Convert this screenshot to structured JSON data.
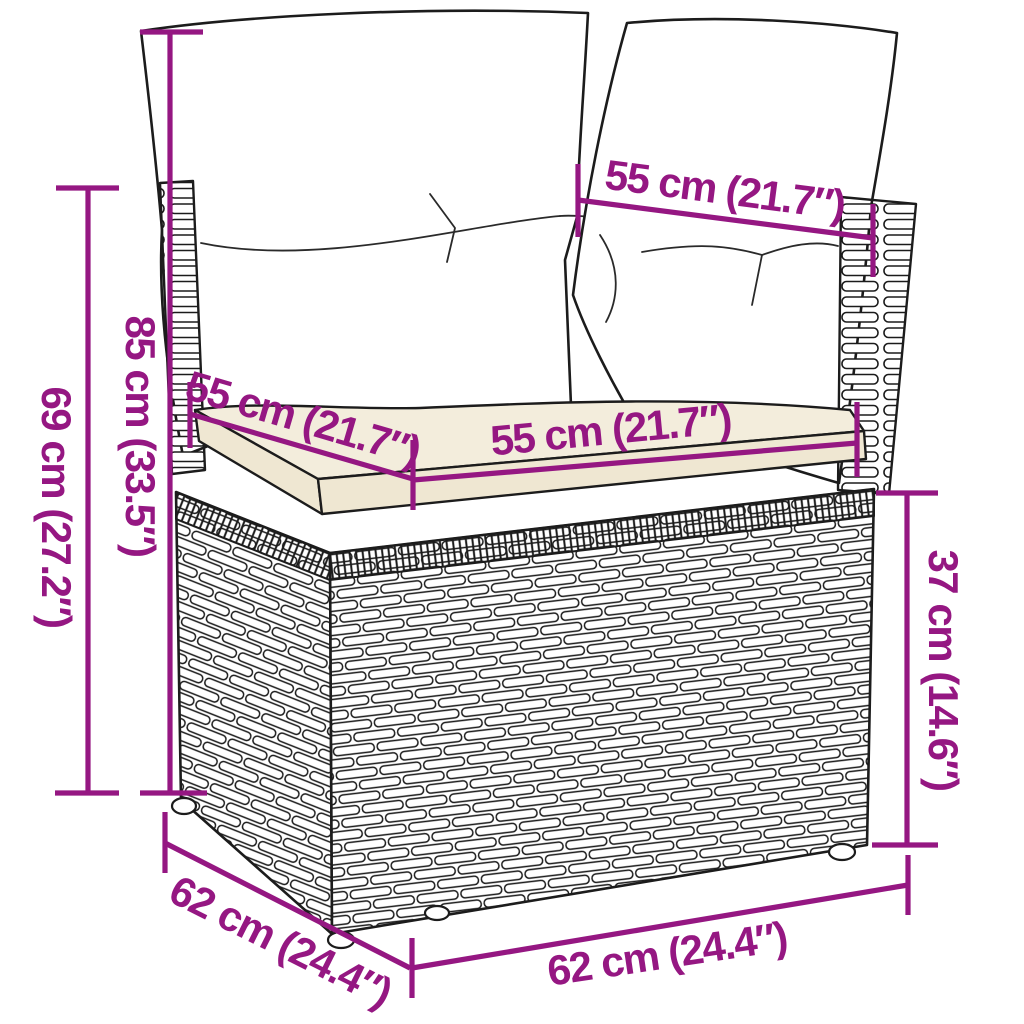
{
  "figure": {
    "description": "line drawing of a poly rattan corner sofa module with back cushions and seat cushion, annotated with measurements",
    "accent_color": "#951782",
    "outline_color": "#1c1c1c",
    "cushion_fill": "#ffffff",
    "seat_cushion_fill": "#f3eddc",
    "seat_rim_fill": "#efe7d2",
    "labels": [
      {
        "id": "back-cushion-width",
        "text": "55 cm (21.7″)"
      },
      {
        "id": "height-with-cushions",
        "text": "85 cm (33.5″)"
      },
      {
        "id": "frame-height",
        "text": "69 cm (27.2″)"
      },
      {
        "id": "seat-cushion-depth",
        "text": "55 cm (21.7″)"
      },
      {
        "id": "seat-cushion-width",
        "text": "55 cm (21.7″)"
      },
      {
        "id": "seat-height",
        "text": "37 cm (14.6″)"
      },
      {
        "id": "base-depth",
        "text": "62 cm (24.4″)"
      },
      {
        "id": "base-width",
        "text": "62 cm (24.4″)"
      }
    ]
  }
}
